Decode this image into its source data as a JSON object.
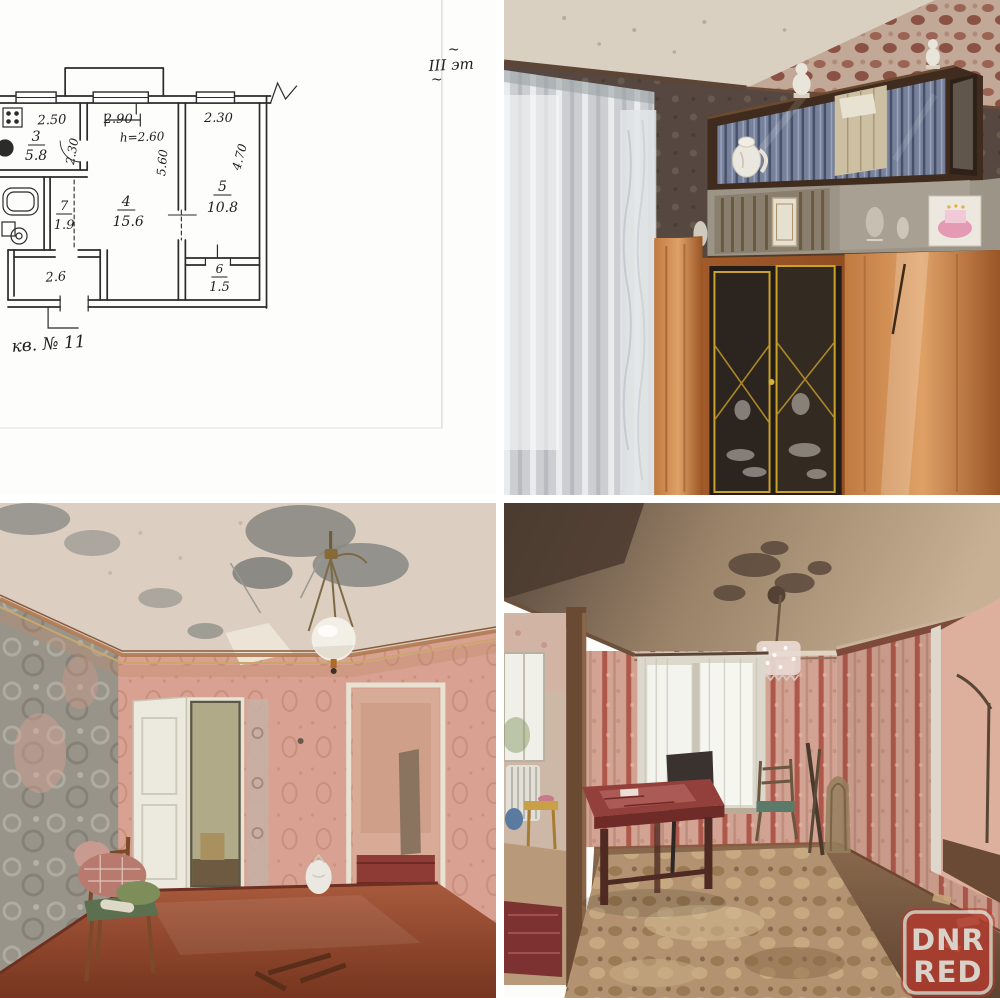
{
  "collage": {
    "grid": "2x2",
    "background_color": "#ffffff"
  },
  "floor_plan": {
    "floor_note_tilde_top": "~",
    "floor_note": "III эт",
    "floor_note_tilde_bottom": "~",
    "apartment_note": "кв. № 11",
    "labels": {
      "kitchen_width": "2.50",
      "kitchen_number": "3",
      "kitchen_area": "5.8",
      "kitchen_depth": "2.30",
      "living_width": "2.90",
      "ceiling_height": "h=2.60",
      "living_depth": "5.60",
      "living_number": "4",
      "living_area": "15.6",
      "bedroom_width": "2.30",
      "bedroom_depth": "4.70",
      "bedroom_number": "5",
      "bedroom_area": "10.8",
      "bath_number": "7",
      "bath_area": "1.9",
      "hallway_area": "2.6",
      "storage_number": "6",
      "storage_area": "1.5"
    }
  },
  "watermark": {
    "line1": "DNR",
    "line2": "RED",
    "badge_color": "#b23b2e",
    "border_color": "#ded5ca",
    "text_color": "#d8d2c8"
  },
  "palette": {
    "plan_ink": "#2b2b2b",
    "wallpaper_dark_brown": "#564840",
    "wallpaper_pink": "#d8a192",
    "wood_orange": "#a75f2c",
    "floor_red_brown": "#8a4630",
    "carpet_tan": "#b29270"
  }
}
